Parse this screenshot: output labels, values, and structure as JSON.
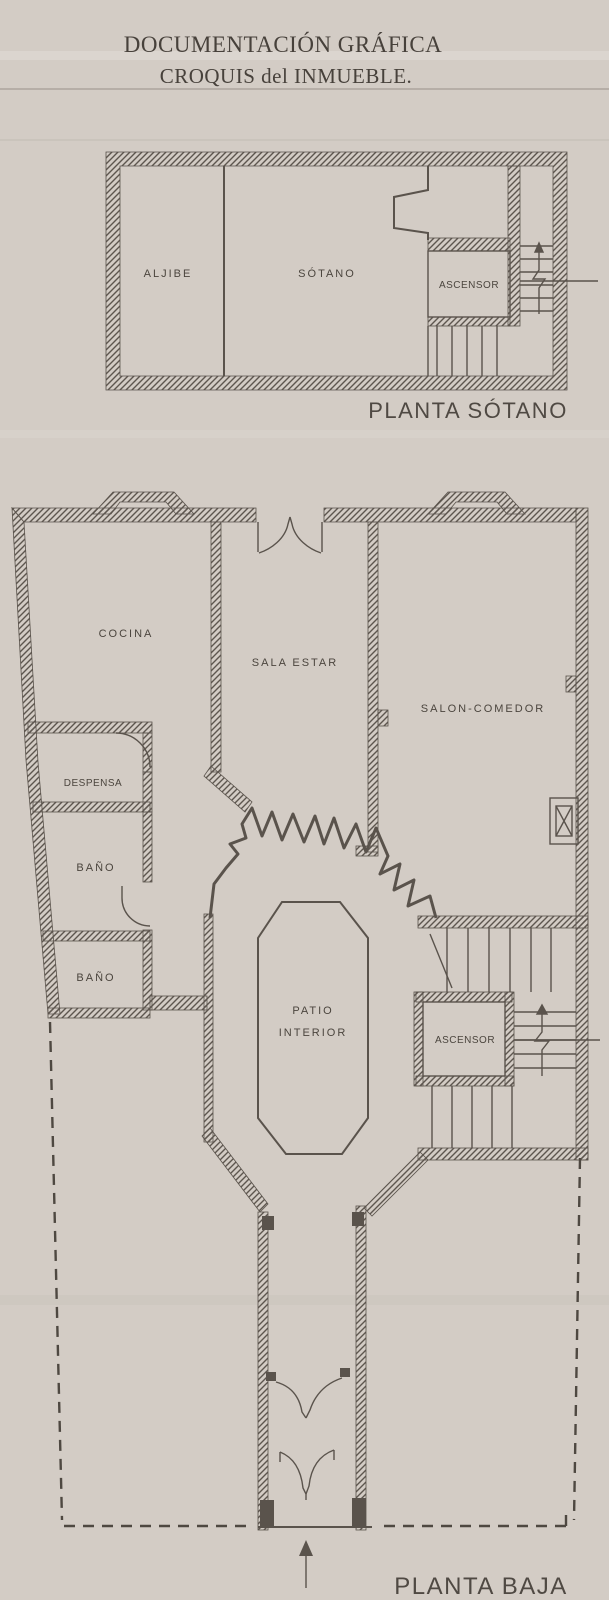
{
  "document": {
    "title_line1": "DOCUMENTACIÓN GRÁFICA",
    "title_line2": "CROQUIS del INMUEBLE."
  },
  "basement_plan": {
    "caption": "PLANTA SÓTANO",
    "rooms": {
      "aljibe": "ALJIBE",
      "sotano": "SÓTANO",
      "ascensor": "ASCENSOR"
    }
  },
  "ground_floor_plan": {
    "caption": "PLANTA BAJA",
    "rooms": {
      "cocina": "COCINA",
      "sala_estar": "SALA ESTAR",
      "salon_comedor": "SALON-COMEDOR",
      "despensa": "DESPENSA",
      "bano_1": "BAÑO",
      "bano_2": "BAÑO",
      "patio_line1": "PATIO",
      "patio_line2": "INTERIOR",
      "ascensor": "ASCENSOR"
    }
  },
  "colors": {
    "paper": "#d3ccc5",
    "ink": "#5a534c",
    "text": "#4b453e"
  }
}
